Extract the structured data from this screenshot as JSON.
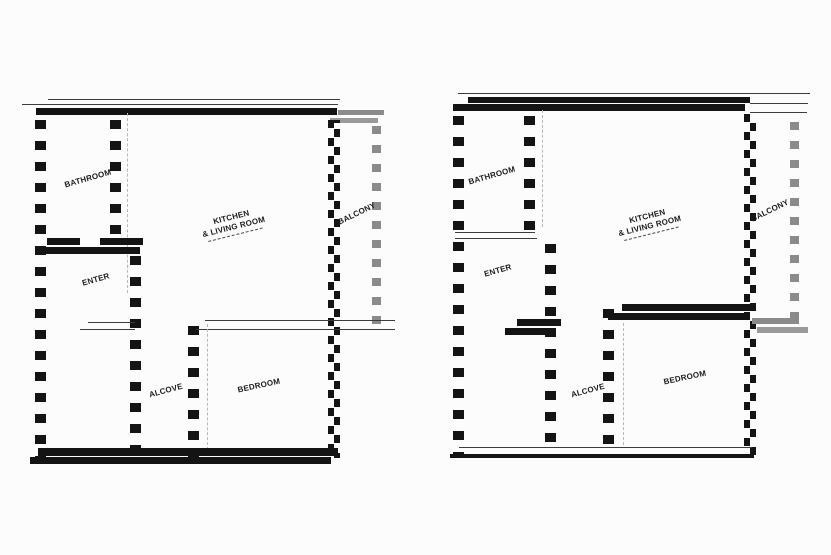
{
  "canvas": {
    "background": "#fcfcfc"
  },
  "colors": {
    "wall": "#141414",
    "balcony_wall": "#8b8b8b",
    "balcony_wall_light": "#9a9a9a",
    "guide_line": "#b8b8b8"
  },
  "plans": {
    "left": {
      "name": "Left unit floor plan",
      "labels": {
        "bathroom": "BATHROOM",
        "kitchen_line1": "KITCHEN",
        "kitchen_line2": "& LIVING ROOM",
        "balcony": "BALCONY",
        "enter": "ENTER",
        "alcove": "ALCOVE",
        "bedroom": "BEDROOM"
      }
    },
    "right": {
      "name": "Right unit floor plan",
      "labels": {
        "bathroom": "BATHROOM",
        "kitchen_line1": "KITCHEN",
        "kitchen_line2": "& LIVING ROOM",
        "balcony": "BALCONY",
        "enter": "ENTER",
        "alcove": "ALCOVE",
        "bedroom": "BEDROOM"
      }
    }
  }
}
